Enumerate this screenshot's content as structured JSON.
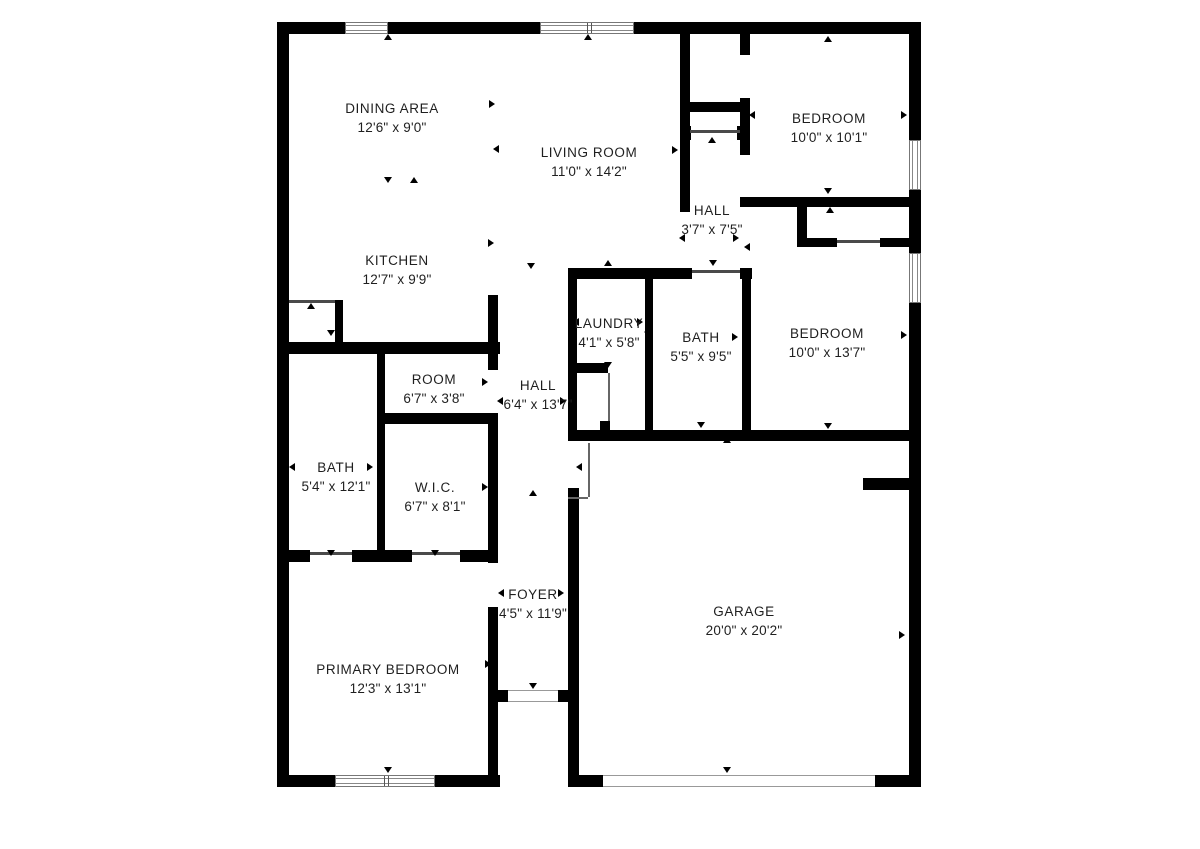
{
  "meta": {
    "type": "floor-plan",
    "wall_color": "#000000",
    "text_color": "#1f1f1f",
    "bg_color": "#ffffff"
  },
  "rooms": [
    {
      "id": "dining-area",
      "name": "DINING AREA",
      "dims": "12'6\" x 9'0\"",
      "x": 392,
      "y": 99
    },
    {
      "id": "living-room",
      "name": "LIVING ROOM",
      "dims": "11'0\" x 14'2\"",
      "x": 589,
      "y": 143
    },
    {
      "id": "bedroom-1",
      "name": "BEDROOM",
      "dims": "10'0\" x 10'1\"",
      "x": 829,
      "y": 109
    },
    {
      "id": "hall-upper",
      "name": "HALL",
      "dims": "3'7\" x 7'5\"",
      "x": 712,
      "y": 201
    },
    {
      "id": "kitchen",
      "name": "KITCHEN",
      "dims": "12'7\" x 9'9\"",
      "x": 397,
      "y": 251
    },
    {
      "id": "laundry",
      "name": "LAUNDRY",
      "dims": "4'1\" x 5'8\"",
      "x": 609,
      "y": 314
    },
    {
      "id": "bath-hall",
      "name": "BATH",
      "dims": "5'5\" x 9'5\"",
      "x": 701,
      "y": 328
    },
    {
      "id": "bedroom-2",
      "name": "BEDROOM",
      "dims": "10'0\" x 13'7\"",
      "x": 827,
      "y": 324
    },
    {
      "id": "room",
      "name": "ROOM",
      "dims": "6'7\" x 3'8\"",
      "x": 434,
      "y": 370
    },
    {
      "id": "hall-main",
      "name": "HALL",
      "dims": "6'4\" x 13'7\"",
      "x": 538,
      "y": 376
    },
    {
      "id": "bath-primary",
      "name": "BATH",
      "dims": "5'4\" x 12'1\"",
      "x": 336,
      "y": 458
    },
    {
      "id": "wic",
      "name": "W.I.C.",
      "dims": "6'7\" x 8'1\"",
      "x": 435,
      "y": 478
    },
    {
      "id": "foyer",
      "name": "FOYER",
      "dims": "4'5\" x 11'9\"",
      "x": 533,
      "y": 585
    },
    {
      "id": "primary-bedroom",
      "name": "PRIMARY BEDROOM",
      "dims": "12'3\" x 13'1\"",
      "x": 388,
      "y": 660
    },
    {
      "id": "garage",
      "name": "GARAGE",
      "dims": "20'0\" x 20'2\"",
      "x": 744,
      "y": 602
    }
  ],
  "walls": [
    [
      277,
      22,
      12,
      765
    ],
    [
      277,
      22,
      68,
      12
    ],
    [
      388,
      22,
      152,
      12
    ],
    [
      634,
      22,
      287,
      12
    ],
    [
      909,
      22,
      12,
      118
    ],
    [
      909,
      190,
      12,
      63
    ],
    [
      909,
      303,
      12,
      484
    ],
    [
      277,
      775,
      58,
      12
    ],
    [
      435,
      775,
      65,
      12
    ],
    [
      570,
      775,
      33,
      12
    ],
    [
      875,
      775,
      46,
      12
    ],
    [
      277,
      342,
      223,
      12
    ],
    [
      335,
      300,
      8,
      45
    ],
    [
      377,
      354,
      8,
      208
    ],
    [
      377,
      413,
      121,
      11
    ],
    [
      488,
      295,
      10,
      75
    ],
    [
      488,
      424,
      10,
      139
    ],
    [
      488,
      607,
      10,
      168
    ],
    [
      289,
      550,
      21,
      12
    ],
    [
      352,
      550,
      26,
      12
    ],
    [
      377,
      550,
      35,
      12
    ],
    [
      460,
      550,
      38,
      12
    ],
    [
      568,
      268,
      124,
      11
    ],
    [
      740,
      268,
      12,
      11
    ],
    [
      568,
      268,
      9,
      172
    ],
    [
      645,
      268,
      8,
      172
    ],
    [
      568,
      363,
      40,
      10
    ],
    [
      600,
      421,
      10,
      10
    ],
    [
      740,
      34,
      10,
      21
    ],
    [
      740,
      98,
      10,
      57
    ],
    [
      740,
      197,
      181,
      10
    ],
    [
      680,
      102,
      70,
      10
    ],
    [
      683,
      126,
      8,
      14
    ],
    [
      737,
      126,
      8,
      14
    ],
    [
      680,
      34,
      10,
      178
    ],
    [
      797,
      207,
      10,
      40
    ],
    [
      797,
      238,
      40,
      9
    ],
    [
      880,
      238,
      41,
      9
    ],
    [
      742,
      279,
      9,
      161
    ],
    [
      568,
      430,
      353,
      11
    ],
    [
      568,
      488,
      11,
      299
    ],
    [
      863,
      478,
      46,
      12
    ],
    [
      497,
      690,
      11,
      12
    ],
    [
      558,
      690,
      20,
      12
    ]
  ],
  "windows": [
    {
      "x": 345,
      "y": 22,
      "w": 43,
      "h": 12,
      "orient": "h",
      "dividers": []
    },
    {
      "x": 540,
      "y": 22,
      "w": 94,
      "h": 12,
      "orient": "h",
      "dividers": [
        46,
        50
      ]
    },
    {
      "x": 909,
      "y": 140,
      "w": 12,
      "h": 50,
      "orient": "v",
      "dividers": []
    },
    {
      "x": 909,
      "y": 253,
      "w": 12,
      "h": 50,
      "orient": "v",
      "dividers": []
    },
    {
      "x": 335,
      "y": 775,
      "w": 100,
      "h": 12,
      "orient": "h",
      "dividers": [
        48,
        52
      ]
    }
  ],
  "openings": [
    {
      "id": "front-door",
      "x": 508,
      "y": 690,
      "w": 50,
      "h": 12
    },
    {
      "id": "garage-door",
      "x": 603,
      "y": 775,
      "w": 272,
      "h": 12
    }
  ],
  "door_lines": [
    [
      289,
      300,
      46,
      3
    ],
    [
      690,
      130,
      50,
      3
    ],
    [
      837,
      240,
      43,
      3
    ],
    [
      310,
      552,
      42,
      3
    ],
    [
      412,
      552,
      48,
      3
    ],
    [
      692,
      270,
      48,
      3
    ]
  ],
  "swing_lines": [
    [
      588,
      443,
      2,
      54
    ],
    [
      568,
      497,
      20,
      2
    ],
    [
      608,
      373,
      2,
      48
    ]
  ],
  "ticks": [
    [
      283,
      104,
      "L"
    ],
    [
      493,
      104,
      "R"
    ],
    [
      283,
      243,
      "L"
    ],
    [
      492,
      243,
      "R"
    ],
    [
      388,
      181,
      "D"
    ],
    [
      414,
      181,
      "U"
    ],
    [
      331,
      334,
      "D"
    ],
    [
      388,
      38,
      "U"
    ],
    [
      588,
      38,
      "U"
    ],
    [
      497,
      149,
      "L"
    ],
    [
      676,
      150,
      "R"
    ],
    [
      828,
      40,
      "U"
    ],
    [
      828,
      192,
      "D"
    ],
    [
      753,
      115,
      "L"
    ],
    [
      905,
      115,
      "R"
    ],
    [
      683,
      238,
      "L"
    ],
    [
      737,
      238,
      "R"
    ],
    [
      712,
      141,
      "U"
    ],
    [
      531,
      267,
      "D"
    ],
    [
      577,
      322,
      "L"
    ],
    [
      641,
      322,
      "R"
    ],
    [
      608,
      264,
      "U"
    ],
    [
      608,
      366,
      "D"
    ],
    [
      648,
      332,
      "L"
    ],
    [
      736,
      337,
      "R"
    ],
    [
      713,
      264,
      "D"
    ],
    [
      701,
      426,
      "D"
    ],
    [
      748,
      247,
      "L"
    ],
    [
      830,
      211,
      "U"
    ],
    [
      828,
      427,
      "D"
    ],
    [
      747,
      335,
      "L"
    ],
    [
      905,
      335,
      "R"
    ],
    [
      382,
      382,
      "L"
    ],
    [
      486,
      382,
      "R"
    ],
    [
      434,
      346,
      "U"
    ],
    [
      434,
      419,
      "D"
    ],
    [
      501,
      401,
      "L"
    ],
    [
      564,
      401,
      "R"
    ],
    [
      533,
      494,
      "U"
    ],
    [
      293,
      467,
      "L"
    ],
    [
      371,
      467,
      "R"
    ],
    [
      331,
      554,
      "D"
    ],
    [
      382,
      487,
      "L"
    ],
    [
      486,
      487,
      "R"
    ],
    [
      435,
      554,
      "D"
    ],
    [
      502,
      593,
      "L"
    ],
    [
      562,
      593,
      "R"
    ],
    [
      533,
      687,
      "D"
    ],
    [
      284,
      664,
      "L"
    ],
    [
      489,
      664,
      "R"
    ],
    [
      388,
      560,
      "U"
    ],
    [
      388,
      771,
      "D"
    ],
    [
      576,
      633,
      "L"
    ],
    [
      903,
      635,
      "R"
    ],
    [
      727,
      441,
      "U"
    ],
    [
      727,
      771,
      "D"
    ],
    [
      580,
      467,
      "L"
    ],
    [
      311,
      307,
      "U"
    ]
  ]
}
